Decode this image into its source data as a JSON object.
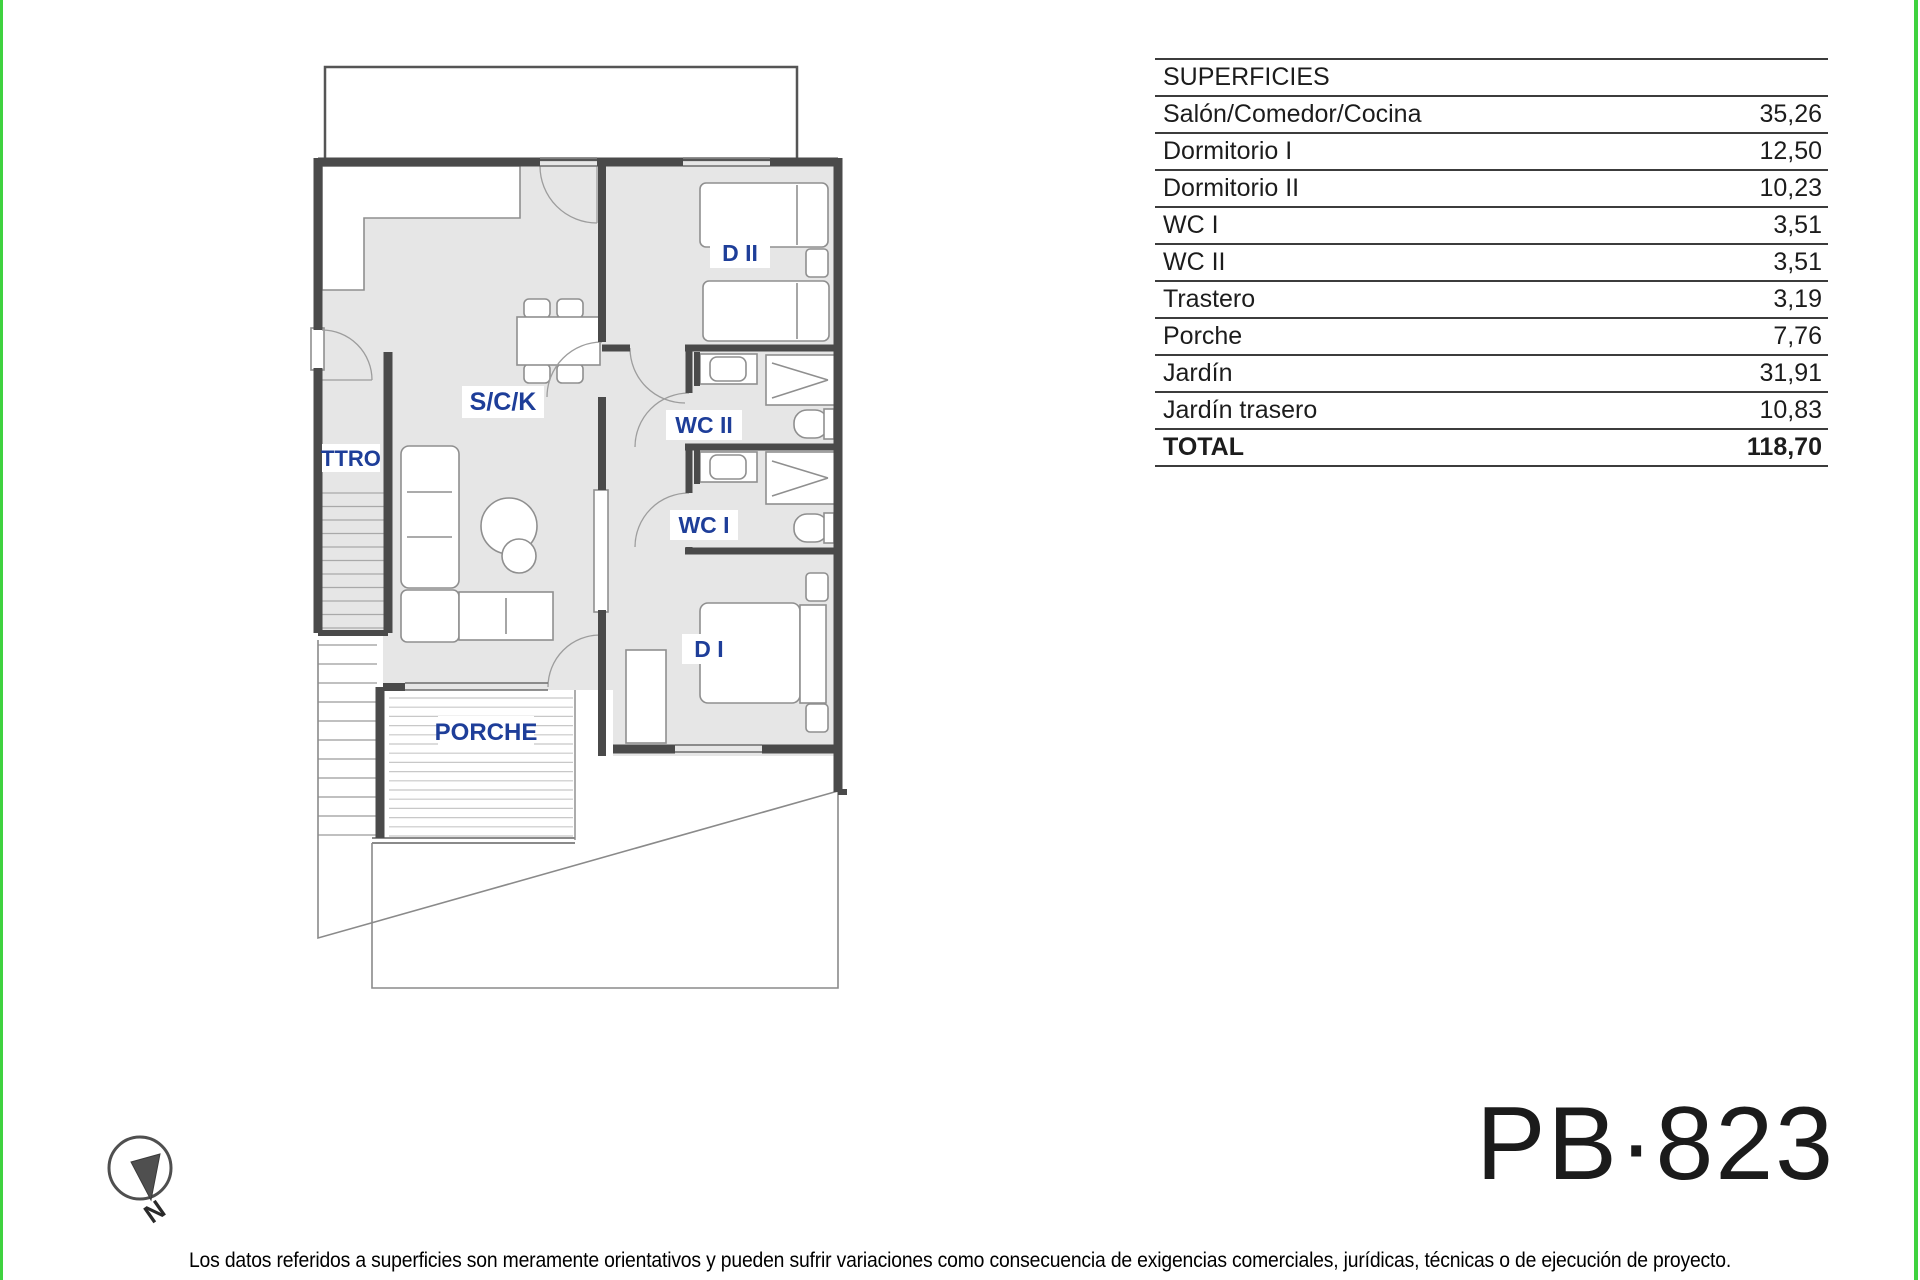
{
  "page": {
    "border_color": "#3fd23f",
    "label_color": "#1e3e99",
    "wall_color": "#4a4a4a",
    "floor_color": "#e6e6e6"
  },
  "surfaces_table": {
    "header": "SUPERFICIES",
    "rows": [
      {
        "label": "Salón/Comedor/Cocina",
        "value": "35,26"
      },
      {
        "label": "Dormitorio I",
        "value": "12,50"
      },
      {
        "label": "Dormitorio II",
        "value": "10,23"
      },
      {
        "label": "WC I",
        "value": "3,51"
      },
      {
        "label": "WC II",
        "value": "3,51"
      },
      {
        "label": "Trastero",
        "value": "3,19"
      },
      {
        "label": "Porche",
        "value": "7,76"
      },
      {
        "label": "Jardín",
        "value": "31,91"
      },
      {
        "label": "Jardín trasero",
        "value": "10,83"
      }
    ],
    "total": {
      "label": "TOTAL",
      "value": "118,70"
    }
  },
  "plan": {
    "labels": {
      "sck": "S/C/K",
      "ttro": "TTRO",
      "d2": "D II",
      "wc2": "WC II",
      "wc1": "WC I",
      "d1": "D I",
      "porche": "PORCHE"
    }
  },
  "compass": {
    "north_label": "N"
  },
  "plan_code": "PB·823",
  "disclaimer": "Los datos referidos a superficies son meramente orientativos y pueden sufrir variaciones como consecuencia de exigencias comerciales, jurídicas, técnicas o de ejecución de proyecto."
}
